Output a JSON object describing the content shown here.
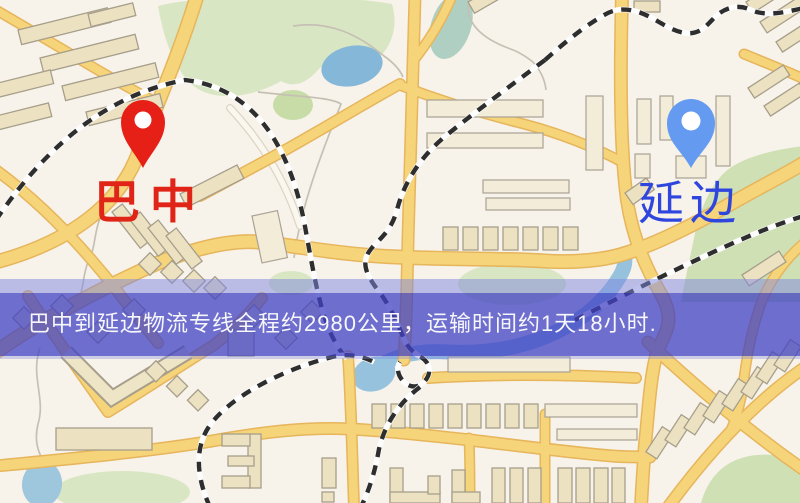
{
  "banner": {
    "text": "巴中到延边物流专线全程约2980公里，运输时间约1天18小时.",
    "bg_color": "#4042c4",
    "text_color": "#f7f7fa"
  },
  "markers": {
    "origin": {
      "label": "巴中",
      "pin_color": "#e61f17",
      "label_color": "#e02418"
    },
    "destination": {
      "label": "延边",
      "pin_color": "#649af0",
      "label_color": "#2f46de"
    }
  },
  "map_palette": {
    "background": "#f7f3ea",
    "road_fill": "#f6d47a",
    "road_casing": "#e6b55c",
    "building_fill": "#ece2c2",
    "building_outline": "#a79e8b",
    "green_area": "#d9e6c3",
    "water": "#96c2de",
    "railway_dark": "#2e2e2e",
    "railway_light": "#fdfdfd"
  }
}
